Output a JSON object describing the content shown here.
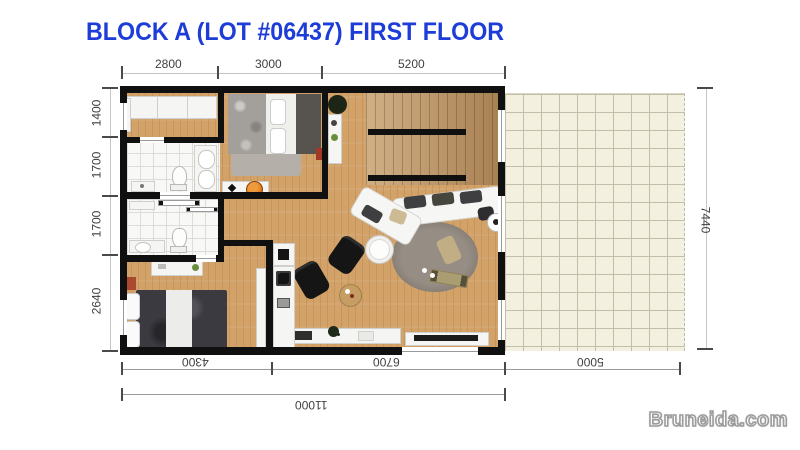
{
  "title": {
    "text": "BLOCK A (LOT #06437) FIRST FLOOR",
    "color": "#1d3cd8"
  },
  "watermark": {
    "text": "Bruneida.com"
  },
  "dims": {
    "top": [
      "2800",
      "3000",
      "5200"
    ],
    "left": [
      "1400",
      "1700",
      "1700",
      "2640"
    ],
    "right": [
      "7440"
    ],
    "bottom": [
      "4300",
      "6700",
      "5000"
    ],
    "total": "11000"
  },
  "colors": {
    "title_blue": "#1d3cd8",
    "wall_black": "#101010",
    "wood_floor": "#d2a269",
    "tile_white": "#f8f8f6",
    "patio_cream": "#f3f0e0",
    "rug_gray": "#8d847c",
    "accent_orange": "#d9731c",
    "dim_text": "#3f3f3f"
  }
}
